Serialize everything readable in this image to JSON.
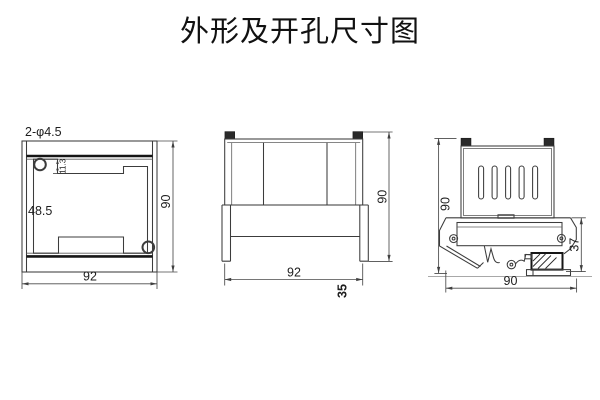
{
  "title": "外形及开孔尺寸图",
  "front_view": {
    "holes_label": "2-φ4.5",
    "pocket_width": "48.5",
    "notch_depth": "11.3",
    "height": "90",
    "width": "92"
  },
  "side_view": {
    "width": "92",
    "height": "90",
    "behind_panel_depth": "35"
  },
  "rail_view": {
    "height": "90",
    "lower_depth": "37",
    "width": "90"
  }
}
